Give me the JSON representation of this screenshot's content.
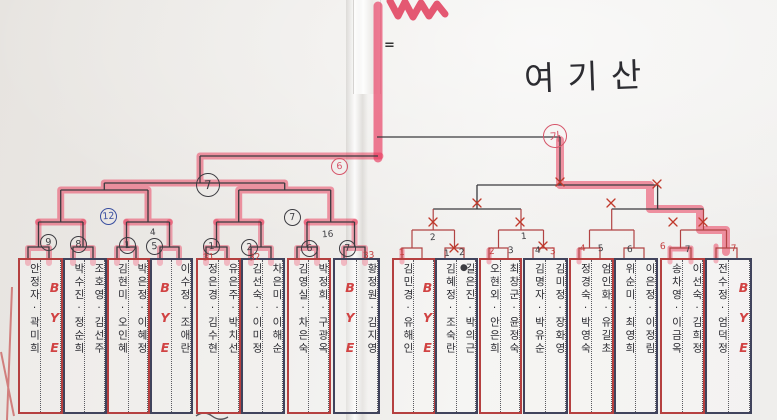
{
  "title": {
    "text": "여기산"
  },
  "marks": {
    "equals": "="
  },
  "colors": {
    "highlighter": "#e8446a",
    "red_pen": "#b14343",
    "black_pen": "#38383c",
    "bye_red": "#d14343",
    "box_red": "#b54040",
    "box_navy": "#40435c",
    "circle_blue": "#3a4fa0"
  },
  "matches": [
    {
      "no": 1,
      "outline": "red",
      "slots": [
        "안정자·곽미희",
        "BYE"
      ]
    },
    {
      "no": 2,
      "outline": "navy",
      "slots": [
        "박수진·정순희",
        "조호영·김선주"
      ]
    },
    {
      "no": 3,
      "outline": "red",
      "slots": [
        "김현미·오인혜",
        "박은정·이혜정"
      ]
    },
    {
      "no": 4,
      "outline": "navy",
      "slots": [
        "BYE",
        "이수정·조애란"
      ]
    },
    {
      "no": 5,
      "outline": "red",
      "slots": [
        "정은경·김수현",
        "유은주·박치선"
      ]
    },
    {
      "no": 6,
      "outline": "navy",
      "slots": [
        "김선숙·이미정",
        "차은미·이해순"
      ]
    },
    {
      "no": 7,
      "outline": "red",
      "slots": [
        "김영실·차은숙",
        "박정희·구광옥"
      ]
    },
    {
      "no": 8,
      "outline": "navy",
      "slots": [
        "BYE",
        "황정원·김지영"
      ]
    },
    {
      "no": 9,
      "outline": "red",
      "slots": [
        "김민경·유해인",
        "BYE"
      ]
    },
    {
      "no": 10,
      "outline": "navy",
      "slots": [
        "김혜정·조숙란",
        "길은진·박의근"
      ]
    },
    {
      "no": 11,
      "outline": "red",
      "slots": [
        "오현외·안은희",
        "최창군·윤정숙"
      ]
    },
    {
      "no": 12,
      "outline": "navy",
      "slots": [
        "김명자·박유순",
        "김미정·장화영"
      ]
    },
    {
      "no": 13,
      "outline": "red",
      "slots": [
        "정경숙·박영숙",
        "엄인화·유길초"
      ]
    },
    {
      "no": 14,
      "outline": "navy",
      "slots": [
        "위순미·최영희",
        "이은정·이정림"
      ]
    },
    {
      "no": 15,
      "outline": "red",
      "slots": [
        "송차영·이금옥",
        "이선숙·김희정"
      ]
    },
    {
      "no": 16,
      "outline": "navy",
      "slots": [
        "전수정·엄덕정",
        "BYE"
      ]
    }
  ],
  "annotations": [
    {
      "text": "9",
      "x": 40,
      "y": 234,
      "cls": "circ"
    },
    {
      "text": "8",
      "x": 70,
      "y": 236,
      "cls": "circ"
    },
    {
      "text": "1",
      "x": 119,
      "y": 237,
      "cls": "circ"
    },
    {
      "text": "5",
      "x": 146,
      "y": 238,
      "cls": "circ"
    },
    {
      "text": "1",
      "x": 203,
      "y": 238,
      "cls": "circ"
    },
    {
      "text": "2",
      "x": 241,
      "y": 239,
      "cls": "circ"
    },
    {
      "text": "6",
      "x": 301,
      "y": 240,
      "cls": "circ"
    },
    {
      "text": "7",
      "x": 339,
      "y": 240,
      "cls": "circ"
    },
    {
      "text": "12",
      "x": 100,
      "y": 208,
      "cls": "circ c-blue"
    },
    {
      "text": "7",
      "x": 196,
      "y": 173,
      "cls": "circ c-big"
    },
    {
      "text": "7",
      "x": 284,
      "y": 209,
      "cls": "circ"
    },
    {
      "text": "가",
      "x": 543,
      "y": 124,
      "cls": "circ c-big c-red"
    },
    {
      "text": "6",
      "x": 331,
      "y": 158,
      "cls": "circ c-red"
    },
    {
      "text": "1",
      "x": 399,
      "y": 248,
      "cls": "t-red"
    },
    {
      "text": "2",
      "x": 489,
      "y": 247,
      "cls": "t-red"
    },
    {
      "text": "3",
      "x": 550,
      "y": 247,
      "cls": "t-red"
    },
    {
      "text": "4",
      "x": 580,
      "y": 244,
      "cls": "t-red"
    },
    {
      "text": "6",
      "x": 660,
      "y": 242,
      "cls": "t-red"
    },
    {
      "text": "7",
      "x": 731,
      "y": 244,
      "cls": "t-red"
    },
    {
      "text": "31",
      "x": 203,
      "y": 253,
      "cls": "t-red"
    },
    {
      "text": "32",
      "x": 249,
      "y": 253,
      "cls": "t-red"
    },
    {
      "text": "33",
      "x": 363,
      "y": 251,
      "cls": "t-red"
    },
    {
      "text": "1",
      "x": 444,
      "y": 249,
      "cls": ""
    },
    {
      "text": "2",
      "x": 459,
      "y": 248,
      "cls": ""
    },
    {
      "text": "3",
      "x": 508,
      "y": 246,
      "cls": ""
    },
    {
      "text": "4",
      "x": 535,
      "y": 246,
      "cls": ""
    },
    {
      "text": "5",
      "x": 598,
      "y": 244,
      "cls": ""
    },
    {
      "text": "6",
      "x": 627,
      "y": 245,
      "cls": ""
    },
    {
      "text": "7",
      "x": 685,
      "y": 245,
      "cls": ""
    },
    {
      "text": "2",
      "x": 430,
      "y": 233,
      "cls": ""
    },
    {
      "text": "1",
      "x": 521,
      "y": 232,
      "cls": ""
    },
    {
      "text": "16",
      "x": 322,
      "y": 230,
      "cls": ""
    },
    {
      "text": "4",
      "x": 150,
      "y": 228,
      "cls": ""
    },
    {
      "text": "●",
      "x": 460,
      "y": 263,
      "cls": ""
    }
  ]
}
